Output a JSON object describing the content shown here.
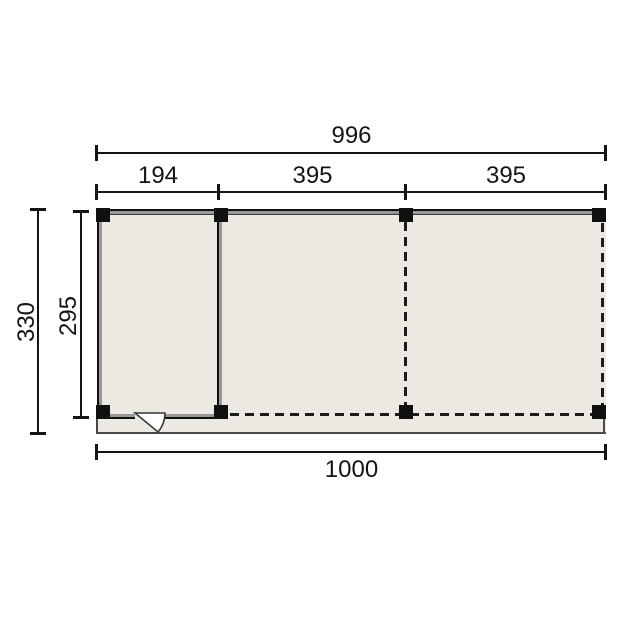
{
  "drawing": {
    "kind": "veranda-floorplan-top-view",
    "dim_top_total": "996",
    "dim_top_segments": [
      "194",
      "395",
      "395"
    ],
    "dim_left_outer": "330",
    "dim_left_inner": "295",
    "dim_bottom_total": "1000",
    "colors": {
      "background": "#ffffff",
      "floor": "#ece8e2",
      "wall_fill": "#989898",
      "wall_edge": "#101010",
      "dimension_line": "#141414",
      "post": "#101010",
      "slab_edge": "#4a4a4a",
      "door_leaf": "#ffffff"
    }
  }
}
